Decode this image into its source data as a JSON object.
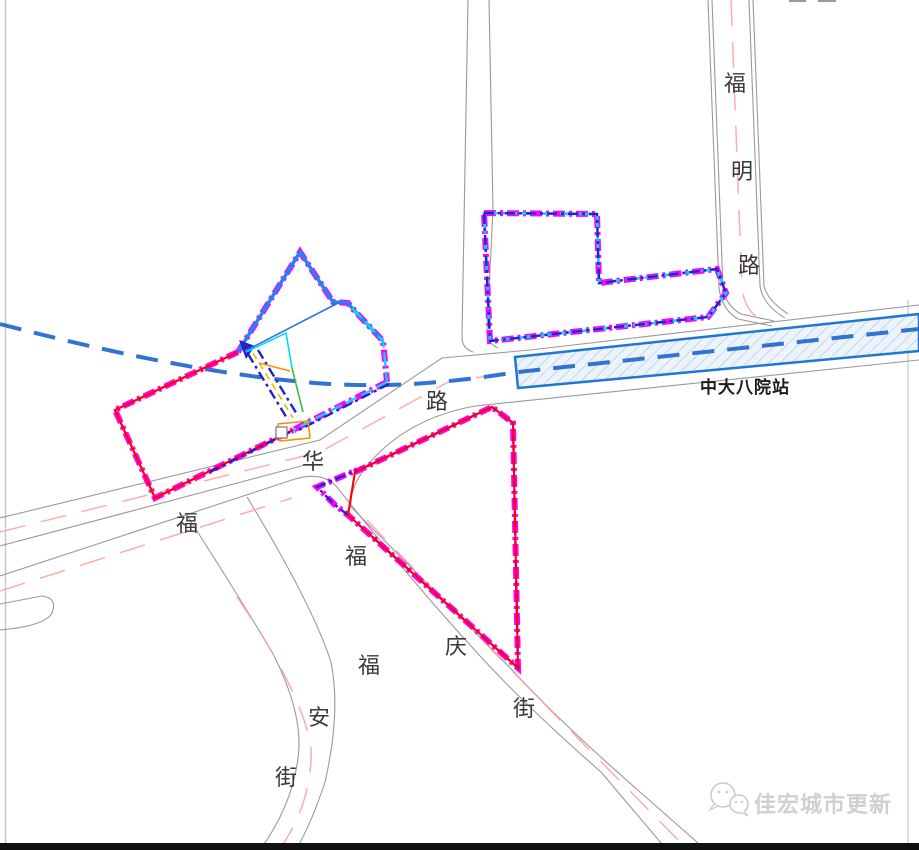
{
  "map": {
    "station": {
      "label": "中大八院站",
      "type": "metro-station-strip",
      "outline_color": "#1e78d2",
      "fill_color": "#edf3fb",
      "hatch_color": "#a8c2e2"
    },
    "roads": {
      "fuming_lu": {
        "name": "福明路",
        "chars": [
          {
            "char": "福"
          },
          {
            "char": "明"
          },
          {
            "char": "路"
          }
        ]
      },
      "fuhua_lu": {
        "name": "福华路",
        "chars": [
          {
            "char": "路"
          },
          {
            "char": "华"
          },
          {
            "char": "福"
          }
        ]
      },
      "fuqing_jie": {
        "name": "福庆街",
        "chars": [
          {
            "char": "福"
          },
          {
            "char": "庆"
          },
          {
            "char": "街"
          }
        ]
      },
      "fuan_jie": {
        "name": "福安街",
        "chars": [
          {
            "char": "福"
          },
          {
            "char": "安"
          },
          {
            "char": "街"
          }
        ]
      }
    },
    "legend_colors": {
      "parcel_boundary_magenta": "#ff00ff",
      "parcel_boundary_navy": "#2222c8",
      "parcel_boundary_cyan": "#00d9ff",
      "parcel_boundary_red": "#ff0000",
      "parcel_edge_blue": "#1e86f0",
      "metro_line_blue": "#2f74d0",
      "road_edge_gray": "#9a9a9a",
      "road_centerline_pink": "#ff9e9e",
      "detail_orange": "#ff8c00",
      "detail_green": "#3fbf3f",
      "detail_yellow": "#e0c000",
      "label_text": "#3a3a3a"
    },
    "watermark": {
      "text": "佳宏城市更新",
      "icon": "wechat-icon",
      "color": "#cbcbcb"
    }
  }
}
